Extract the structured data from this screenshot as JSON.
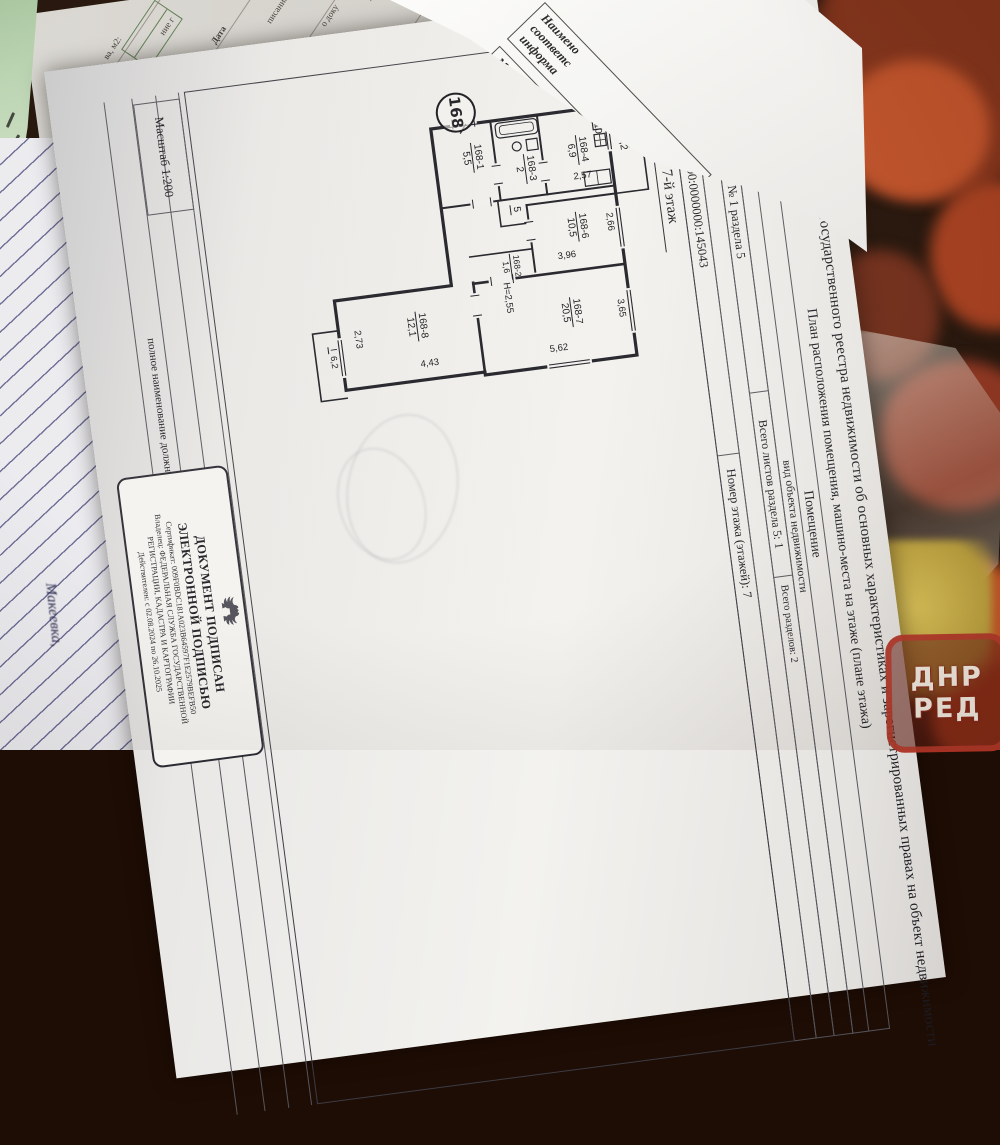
{
  "photo": {
    "watermark": {
      "line1": "ДНР",
      "line2": "РЕД"
    },
    "handwriting": "Макеевка,",
    "colors": {
      "accent_red": "#b03426",
      "paper": "#f3f2ef",
      "fruit_red": "#a53e1c",
      "lemon": "#c2a83e"
    }
  },
  "strip": {
    "f1": "ва, м2:",
    "f2": "ние г",
    "f3": "Дата",
    "f4": "писание:",
    "f5": "о доку",
    "f6": "Руб.",
    "f7": "ник:",
    "f8": "з, на",
    "f9": "серти",
    "f10": "КН"
  },
  "fold": {
    "f1": "Наимено",
    "f2": "соответс",
    "f3": "информа",
    "f4": "Место нах",
    "f5": "соответст",
    "f6": "информаци"
  },
  "doc": {
    "title": "Выписка из Единого государственного реестра недвижимости об основных характеристиках и зарегистрированных правах на объект недвижимости",
    "subtitle": "План расположения помещения, машино-места на этаже (плане этажа)",
    "table": {
      "object_kind": "Помещение",
      "object_kind_note": "вид объекта недвижимости",
      "sheet": "Лист № 1 раздела 5",
      "sheets_total": "Всего листов раздела 5: 1",
      "sections_total": "Всего разделов: 2",
      "date": "26.09.2024г.",
      "cadastral_number": "Кадастровый номер: 93:00:0000000:145043",
      "floor_number": "Номер этажа (этажей): 7"
    },
    "plan": {
      "floor_title": "7-й этаж",
      "apartment_number": "168",
      "ceiling_height": "Н=2,55",
      "rooms": {
        "r1": {
          "id": "168-1",
          "area": "5,5"
        },
        "r2": {
          "id": "168-2",
          "area": "1,6"
        },
        "r3": {
          "id": "168-3",
          "area": "2"
        },
        "r4": {
          "id": "168-4",
          "area": "6,9"
        },
        "r5": {
          "id": "5",
          "area": ""
        },
        "r6": {
          "id": "168-6",
          "area": "10,5"
        },
        "r7": {
          "id": "168-7",
          "area": "20,5"
        },
        "r8": {
          "id": "168-8",
          "area": "12,1"
        }
      },
      "balconies": {
        "b1": {
          "id": "I",
          "area": "6,2"
        },
        "b2": {
          "id": "II",
          "area": "3,2"
        }
      },
      "dims": {
        "d310": "3,10",
        "d257": "2,57",
        "d266": "2,66",
        "d396": "3,96",
        "d365": "3,65",
        "d562": "5,62",
        "d273": "2,73",
        "d443": "4,43"
      }
    },
    "footer": {
      "scale": "Масштаб 1:200",
      "position_note": "полное наименование должности"
    },
    "stamp": {
      "title1": "ДОКУМЕНТ ПОДПИСАН",
      "title2": "ЭЛЕКТРОННОЙ ПОДПИСЬЮ",
      "certificate": "Сертификат: 009F0BDC181A023B64597F1E2579BEFB50",
      "owner": "Владелец: ФЕДЕРАЛЬНАЯ СЛУЖБА ГОСУДАРСТВЕННОЙ",
      "owner2": "РЕГИСТРАЦИИ, КАДАСТРА И КАРТОГРАФИИ",
      "validity": "Действителен: с 02.08.2024 по 26.10.2025"
    }
  }
}
